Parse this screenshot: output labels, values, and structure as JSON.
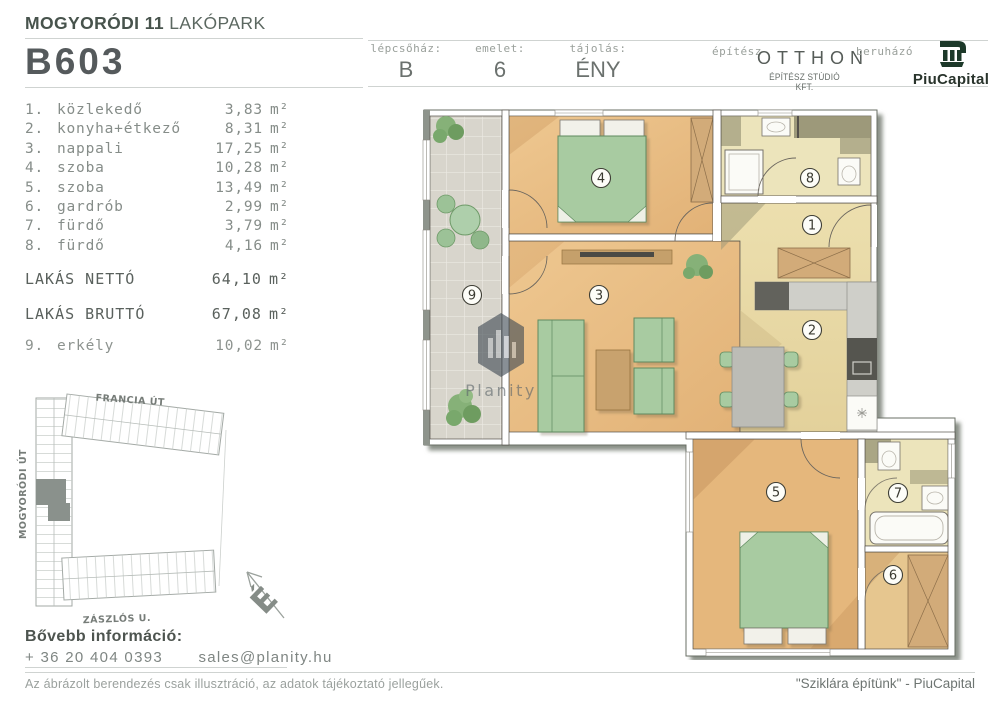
{
  "project": {
    "title_bold": "MOGYORÓDI 11",
    "title_light": "LAKÓPARK",
    "unit_code": "B603"
  },
  "header": {
    "cells": [
      {
        "label": "lépcsőház:",
        "value": "B"
      },
      {
        "label": "emelet:",
        "value": "6"
      },
      {
        "label": "tájolás:",
        "value": "ÉNY"
      }
    ],
    "architect_label": "építész",
    "architect_name": "OTTHON",
    "architect_sub": "ÉPÍTÉSZ STÚDIÓ KFT.",
    "developer_label": "beruházó",
    "developer_name": "PiuCapital"
  },
  "rooms": [
    {
      "num": "1.",
      "name": "közlekedő",
      "area": "3,83",
      "unit": "m²"
    },
    {
      "num": "2.",
      "name": "konyha+étkező",
      "area": "8,31",
      "unit": "m²"
    },
    {
      "num": "3.",
      "name": "nappali",
      "area": "17,25",
      "unit": "m²"
    },
    {
      "num": "4.",
      "name": "szoba",
      "area": "10,28",
      "unit": "m²"
    },
    {
      "num": "5.",
      "name": "szoba",
      "area": "13,49",
      "unit": "m²"
    },
    {
      "num": "6.",
      "name": "gardrób",
      "area": "2,99",
      "unit": "m²"
    },
    {
      "num": "7.",
      "name": "fürdő",
      "area": "3,79",
      "unit": "m²"
    },
    {
      "num": "8.",
      "name": "fürdő",
      "area": "4,16",
      "unit": "m²"
    }
  ],
  "totals": {
    "net_label": "LAKÁS NETTÓ",
    "net_area": "64,10",
    "gross_label": "LAKÁS BRUTTÓ",
    "gross_area": "67,08",
    "unit": "m²"
  },
  "balcony_row": {
    "num": "9.",
    "name": "erkély",
    "area": "10,02",
    "unit": "m²"
  },
  "site_map": {
    "street_top": "FRANCIA ÚT",
    "street_left": "MOGYORÓDI ÚT",
    "street_bottom": "ZÁSZLÓS U.",
    "compass_letter": "É"
  },
  "plan": {
    "watermark": "Planity",
    "labels": [
      "1",
      "2",
      "3",
      "4",
      "5",
      "6",
      "7",
      "8",
      "9"
    ]
  },
  "contact": {
    "heading": "Bővebb információ:",
    "phone": "+ 36 20 404 0393",
    "email": "sales@planity.hu"
  },
  "footer": {
    "disclaimer": "Az ábrázolt berendezés csak illusztráció, az adatok tájékoztató jellegűek.",
    "slogan": "\"Sziklára építünk\" - PiuCapital"
  },
  "colors": {
    "brand_green": "#1d392a",
    "wood": "#e9c28c",
    "cream": "#e9dba9",
    "bath": "#ece4bb",
    "furniture_green": "#a8cba1"
  }
}
